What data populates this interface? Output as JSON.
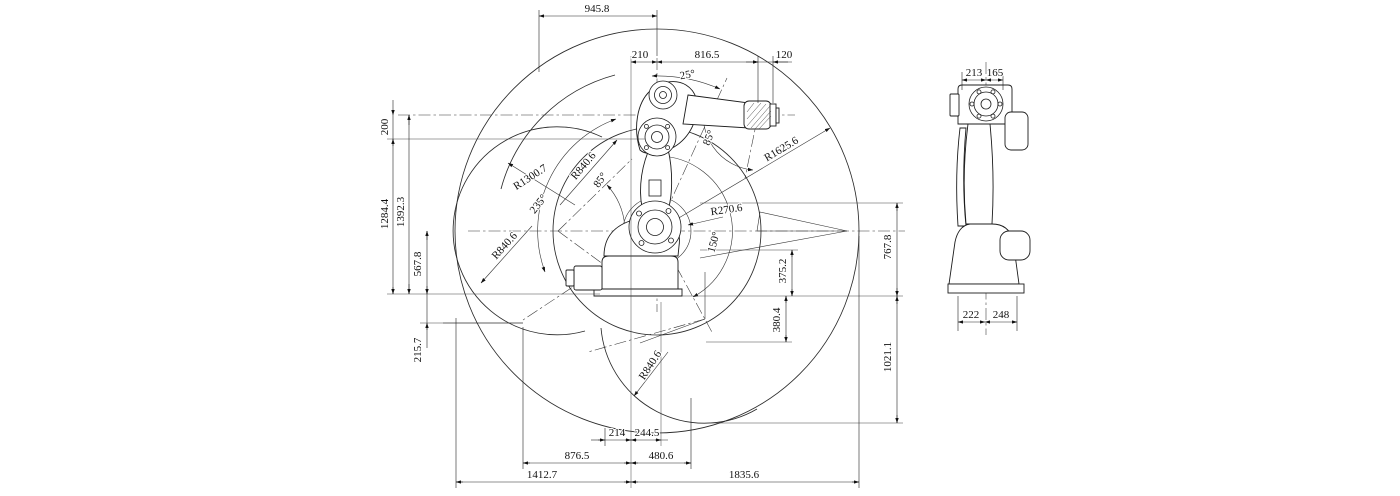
{
  "colors": {
    "line": "#1c1c1c",
    "background": "#ffffff"
  },
  "front_view": {
    "top_dims": [
      "945.8",
      "210",
      "816.5",
      "120"
    ],
    "left_dims": [
      "200",
      "1284.4",
      "1392.3",
      "567.8",
      "215.7"
    ],
    "right_dims": [
      "767.8",
      "375.2",
      "380.4",
      "1021.1"
    ],
    "bottom_dims": [
      "214",
      "244.5",
      "876.5",
      "480.6",
      "1412.7",
      "1835.6"
    ],
    "radii": [
      "R1300.7",
      "R840.6",
      "R840.6",
      "R840.6",
      "R1625.6",
      "R270.6"
    ],
    "angles": [
      "25°",
      "85°",
      "85°",
      "235°",
      "150°"
    ]
  },
  "side_view": {
    "top_dims": [
      "213",
      "165"
    ],
    "bottom_dims": [
      "222",
      "248"
    ]
  }
}
